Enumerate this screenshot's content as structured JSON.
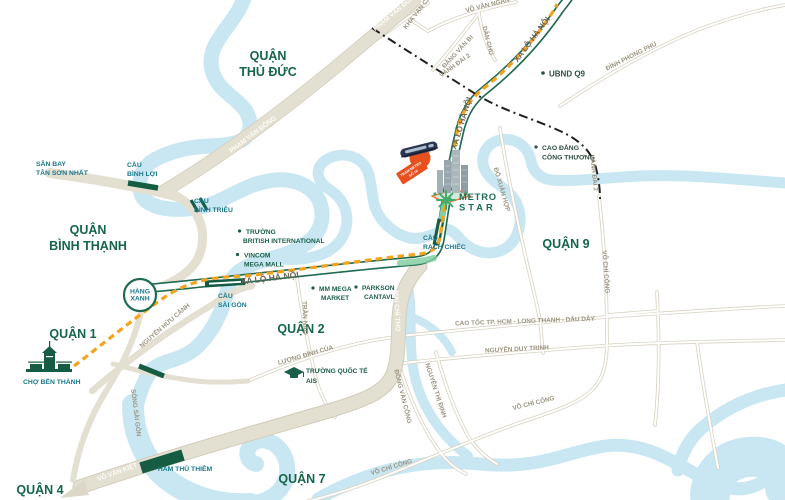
{
  "project": {
    "logo_l1": "METRO",
    "logo_l2": "STAR",
    "station_l1": "TRẠM METRO",
    "station_l2": "SỐ 10"
  },
  "districts": {
    "thu_duc": {
      "l1": "QUẬN",
      "l2": "THỦ ĐỨC"
    },
    "binh_thanh": {
      "l1": "QUẬN",
      "l2": "BÌNH THẠNH"
    },
    "q1": "QUẬN 1",
    "q2": "QUẬN 2",
    "q4": "QUẬN 4",
    "q7": "QUẬN 7",
    "q9": "QUẬN 9"
  },
  "places": {
    "san_bay": {
      "l1": "SÂN BAY",
      "l2": "TÂN SƠN NHẤT"
    },
    "cho_ben_thanh": "CHỢ BẾN THÀNH",
    "hang_xanh": {
      "l1": "HÀNG",
      "l2": "XANH"
    },
    "ubnd_q9": "UBND Q9",
    "cao_dang": {
      "l1": "CAO ĐẲNG",
      "l2": "CÔNG THƯƠNG"
    },
    "british": {
      "l1": "TRƯỜNG",
      "l2": "BRITISH INTERNATIONAL"
    },
    "vincom": {
      "l1": "VINCOM",
      "l2": "MEGA MALL"
    },
    "mm_mega": {
      "l1": "MM MEGA",
      "l2": "MARKET"
    },
    "parkson": {
      "l1": "PARKSON",
      "l2": "CANTAVL"
    },
    "ais": {
      "l1": "TRƯỜNG QUỐC TẾ",
      "l2": "AIS"
    }
  },
  "crossings": {
    "cau_binh_loi": {
      "l1": "CẦU",
      "l2": "BÌNH LỢI"
    },
    "cau_binh_trieu": {
      "l1": "CẦU",
      "l2": "BÌNH TRIỆU"
    },
    "cau_sai_gon": {
      "l1": "CẦU",
      "l2": "SÀI GÒN"
    },
    "cau_rach_chiec": {
      "l1": "CẦU",
      "l2": "RẠCH CHIẾC"
    },
    "ham_thu_thiem": "HẦM THỦ THIÊM"
  },
  "roads": {
    "pham_van_dong": "PHẠM VĂN ĐỒNG",
    "kha_van_can": "KHA VẠN CÂN",
    "vo_van_ngan": "VÕ VĂN NGÂN",
    "dang_van_bi": "ĐẶNG VĂN BI",
    "dan_chu": "DÂN CHỦ",
    "vanh_dai_2": "VÀNH ĐAI 2",
    "xa_lo_ha_noi": "XA LỘ HÀ NỘI",
    "nguyen_huu_canh": "NGUYỄN HỮU CẢNH",
    "tran_nao": "TRẦN NÃO",
    "mai_chi_tho": "MAI CHÍ THỌ",
    "luong_dinh_cua": "LƯƠNG ĐÌNH CỦA",
    "dong_van_cong": "ĐỒNG VĂN CỐNG",
    "nguyen_thi_dinh": "NGUYỄN THỊ ĐỊNH",
    "nguyen_duy_trinh": "NGUYỄN DUY TRINH",
    "cao_toc": "CAO TỐC TP. HCM - LONG THÀNH - DẦU DÂY",
    "vo_chi_cong": "VÕ CHÍ CÔNG",
    "vo_van_kiet": "VÕ VĂN KIỆT",
    "do_xuan_hop": "ĐỖ XUÂN HỢP",
    "dinh_phong_phu": "ĐÌNH PHONG PHÚ"
  },
  "water": {
    "song_sai_gon": "SÔNG SÀI GÒN"
  },
  "colors": {
    "river": "#c9e7f2",
    "road_tan": "#e3dfd1",
    "highway_green": "#1f6b50",
    "highway_highlight": "#85cfa3",
    "bridge_green": "#155c43",
    "metro_orange": "#f5a31f",
    "ring_road_black": "#1f1f1f",
    "district_green": "#156649",
    "poi_teal": "#19788a",
    "logo_green": "#3fae6e",
    "station_red": "#e8501e"
  }
}
